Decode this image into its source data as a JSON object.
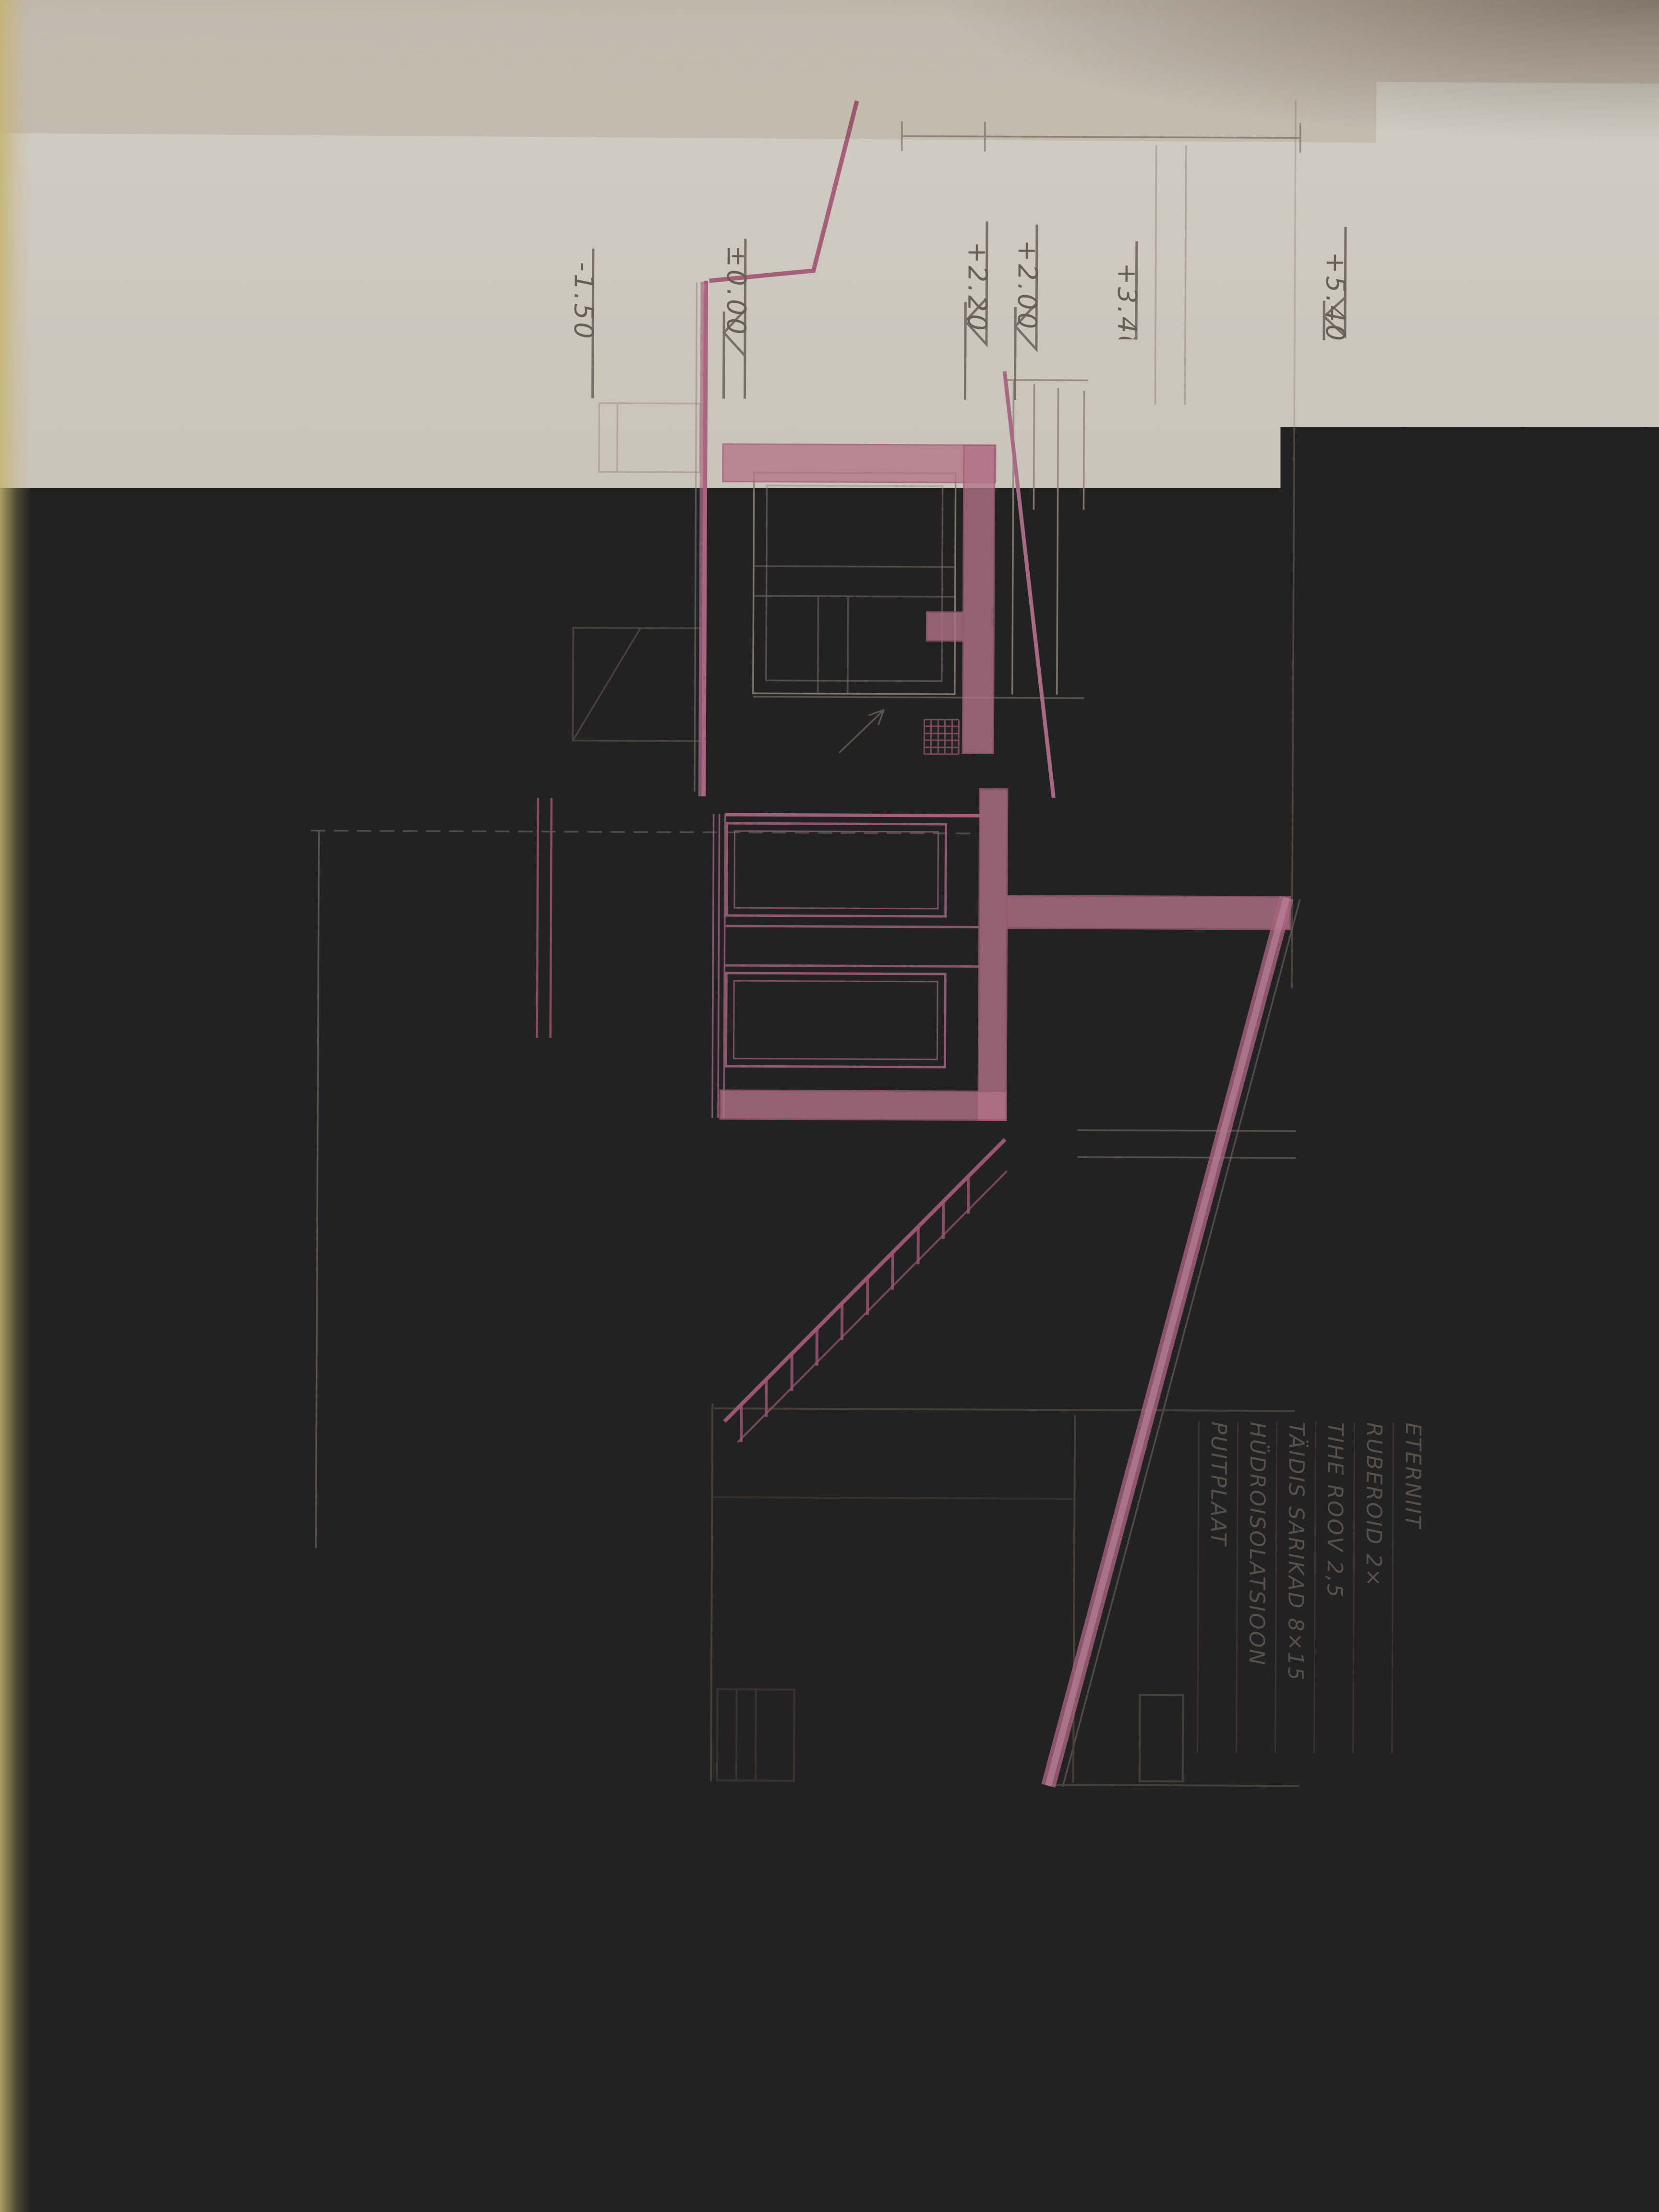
{
  "title": {
    "name": "LÕIGE A-A",
    "scale": "M 1:50"
  },
  "notes": {
    "roof_upper": {
      "lines": [
        "RUBEROID 3 ×",
        "THE ROOV 2.5",
        "TALA 8×15 TÄIDIS",
        "LAUD 2,0 CM"
      ]
    },
    "floor_upper": {
      "lines": [
        "PUITPÕRAND",
        "TSEMENT PÕR. 3 CM",
        "BETOON 5 CM",
        "KILLUSTIK"
      ]
    },
    "floor_ground": {
      "lines": [
        "TSEMENT 3.0 CM",
        "BETOON 5.0 CM",
        "KILLUSTIK 10 CM"
      ]
    },
    "roof_lower": {
      "lines": [
        "ETERNIIT",
        "RUBEROID 2×",
        "TIHE ROOV 2,5",
        "TÄIDIS SARIKAD 8×15",
        "HÜDROISOLATSIOON",
        "PUITPLAAT"
      ]
    },
    "floor_lower": {
      "lines": [
        "PUITPÕRAND",
        "TÄIDIS",
        "R/BETOON"
      ]
    },
    "beam_size": "4*60"
  },
  "elevations": {
    "upper": [
      "-1.50",
      "±0.00",
      "+2.20",
      "+2.00",
      "+3.40",
      "+5.40"
    ],
    "lower": [
      "-3.60",
      "-2.70",
      "-0.30",
      "±0.00",
      "+2.20",
      "+2.50",
      "+2.70",
      "+3.50",
      "+5.85"
    ]
  },
  "colors": {
    "paper": "#cbc5bc",
    "pink_line": "#a0607a",
    "pink_fill": "#b4738a",
    "pencil": "#8d8276",
    "shadow_brown": "#7d695a",
    "graphite": "#675f56"
  }
}
